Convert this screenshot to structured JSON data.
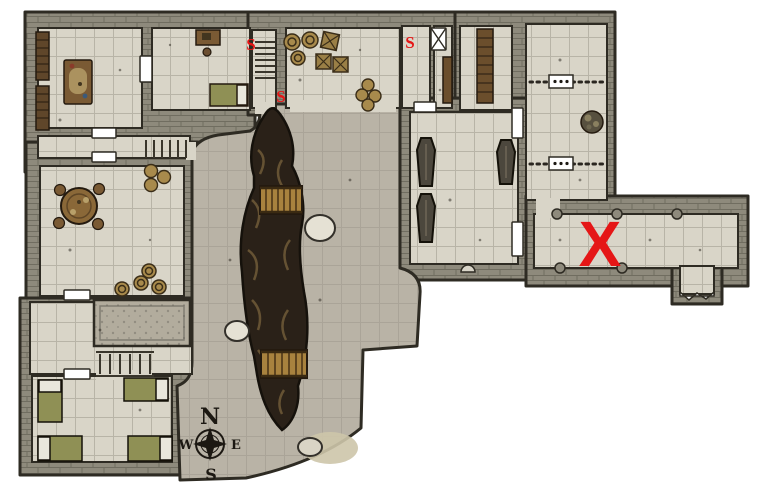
{
  "map_type": "dungeon-battle-map",
  "compass": {
    "north": "N",
    "south": "S",
    "east": "E",
    "west": "W"
  },
  "markers": {
    "secret_doors": [
      {
        "id": "s1",
        "label": "S"
      },
      {
        "id": "s2",
        "label": "S"
      },
      {
        "id": "s3",
        "label": "S"
      }
    ],
    "x_mark": {
      "id": "x1",
      "label": "X"
    }
  },
  "colors": {
    "background": "#ffffff",
    "wall_stone": "#8e8a7c",
    "wall_outline": "#2e2b23",
    "room_floor": "#d9d5c8",
    "cave_floor": "#b9b3a6",
    "chasm": "#2a2118",
    "chasm_ridge": "#705a38",
    "bridge_wood": "#a8823e",
    "furniture_wood": "#7a5a34",
    "barrel": "#a88a4c",
    "coffin": "#4c473d",
    "bed_blanket": "#8f9055",
    "bed_pillow": "#e9e7dc",
    "door": "#ffffff",
    "marker_red": "#e51616",
    "compass_ink": "#1c1812"
  },
  "features": {
    "rooms": [
      "library",
      "bedroom",
      "north-stairwell",
      "storage-room",
      "north-corridors",
      "shelf-room",
      "east-guard-room",
      "crypt",
      "meeting-room",
      "platform-hall",
      "barracks",
      "east-corridor",
      "central-cavern"
    ],
    "furniture": [
      "bookshelves",
      "work-table",
      "desk",
      "stool",
      "single-bed",
      "storage-barrels",
      "storage-crates",
      "wall-barrels",
      "wooden-shelves",
      "coffins",
      "round-table",
      "chairs",
      "barrel-clusters",
      "barracks-beds"
    ],
    "structures": [
      "doors",
      "portcullis-door",
      "bar-gates",
      "north-stairs",
      "west-stairs",
      "south-stairs",
      "north-bridge",
      "south-bridge",
      "chasm",
      "boulders",
      "rubble-platform",
      "wall-pillars",
      "south-alcove",
      "compass-rose"
    ]
  }
}
